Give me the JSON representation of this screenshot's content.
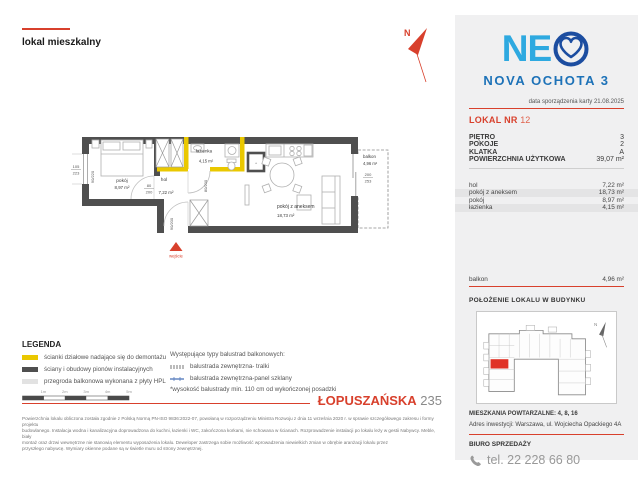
{
  "header": {
    "unit_type_label": "lokal mieszkalny"
  },
  "logo": {
    "brand_text": "NE",
    "project": "NOVA OCHOTA 3"
  },
  "card": {
    "date_label": "data sporządzenia karty 21.08.2025",
    "unit_label": "LOKAL NR",
    "unit_number": "12",
    "attributes": [
      {
        "label": "PIĘTRO",
        "value": "3"
      },
      {
        "label": "POKOJE",
        "value": "2"
      },
      {
        "label": "KLATKA",
        "value": "A"
      },
      {
        "label": "POWIERZCHNIA UŻYTKOWA",
        "value": "39,07 m²"
      }
    ],
    "rooms": [
      {
        "name": "hol",
        "area": "7,22 m²"
      },
      {
        "name": "pokój z aneksem",
        "area": "18,73 m²"
      },
      {
        "name": "pokój",
        "area": "8,97 m²"
      },
      {
        "name": "łazienka",
        "area": "4,15 m²"
      }
    ],
    "balcony": {
      "name": "balkon",
      "area": "4,96 m²"
    },
    "location_heading": "POŁOŻENIE LOKALU W BUDYNKU",
    "repeat_units": "MIESZKANIA POWTARZALNE: 4, 8, 16",
    "address": "Adres inwestycji: Warszawa, ul. Wojciecha Opackiego 4A",
    "sales_office_label": "BIURO SPRZEDAŻY",
    "phone": "tel. 22 228 66 80"
  },
  "plan": {
    "compass_label": "N",
    "entrance_label": "wejście",
    "rooms": {
      "bedroom": {
        "name": "pokój",
        "area": "8,97 m²"
      },
      "hall": {
        "name": "hol",
        "area": "7,22 m²"
      },
      "bathroom": {
        "name": "łazienka",
        "area": "4,15 m²"
      },
      "living": {
        "name": "pokój z aneksem",
        "area": "18,73 m²"
      },
      "balcony": {
        "name": "balkon",
        "area": "4,96 m²"
      }
    },
    "dimensions": {
      "window_width": "105",
      "window_height": "223",
      "window_side": "90/220",
      "bedroom_door_width": "80",
      "bedroom_door_height": "200",
      "bathroom_door": "80/200",
      "entrance_door": "90/200",
      "balcony_door_width": "200",
      "balcony_door_height": "253"
    }
  },
  "legend": {
    "title": "LEGENDA",
    "items": [
      {
        "swatch": "yellow",
        "label": "ścianki działowe nadające się do demontażu"
      },
      {
        "swatch": "dark",
        "label": "ściany i obudowy pionów instalacyjnych"
      },
      {
        "swatch": "light",
        "label": "przegroda balkonowa wykonana z płyty HPL"
      }
    ],
    "right": {
      "heading": "Występujące typy balustrad balkonowych:",
      "items": [
        {
          "icon": "balusters",
          "label": "balustrada zewnętrzna- tralki"
        },
        {
          "icon": "glass-panel",
          "label": "balustrada zewnętrzna-panel szklany"
        }
      ],
      "note": "*wysokość balustrady min. 110 cm od wykończonej posadzki"
    }
  },
  "scale_bar": {
    "labels": [
      "1m",
      "2m",
      "3m",
      "4m",
      "5m"
    ]
  },
  "footer": {
    "street": "ŁOPUSZAŃSKA",
    "street_number": "235",
    "disclaimer_lines": [
      "Powierzchnia lokalu obliczona została zgodnie z Polską Normą PN-ISO 9836:2022-07, powołaną w rozporządzeniu Ministra Rozwoju z dnia 11 września 2020 r. w sprawie szczegółowego zakresu i formy projektu",
      "budowlanego. Instalacja wodna i kanalizacyjna doprowadzona do kuchni, łazienki i WC, zakończona korkami, nie schowana w ścianach. Rozprowadzenie instalacji po lokalu leży w gestii Nabywcy. Meble, biały",
      "montaż oraz drzwi wewnętrzne nie stanowią elementu wyposażenia lokalu. Deweloper zastrzega sobie możliwość wprowadzenia niewielkich zmian w obrębie aranżacji lokalu przez",
      "przyszłego nabywcę. Wymiary okienne podane są w świetle muru od strony zewnętrznej."
    ]
  },
  "colors": {
    "accent_red": "#d8402c",
    "brand_light_blue": "#2ea9e0",
    "brand_dark_blue": "#1c4da0",
    "brand_mid_blue": "#1d72b8",
    "wall_dark": "#4f4f4f",
    "partition_yellow": "#eac800"
  }
}
